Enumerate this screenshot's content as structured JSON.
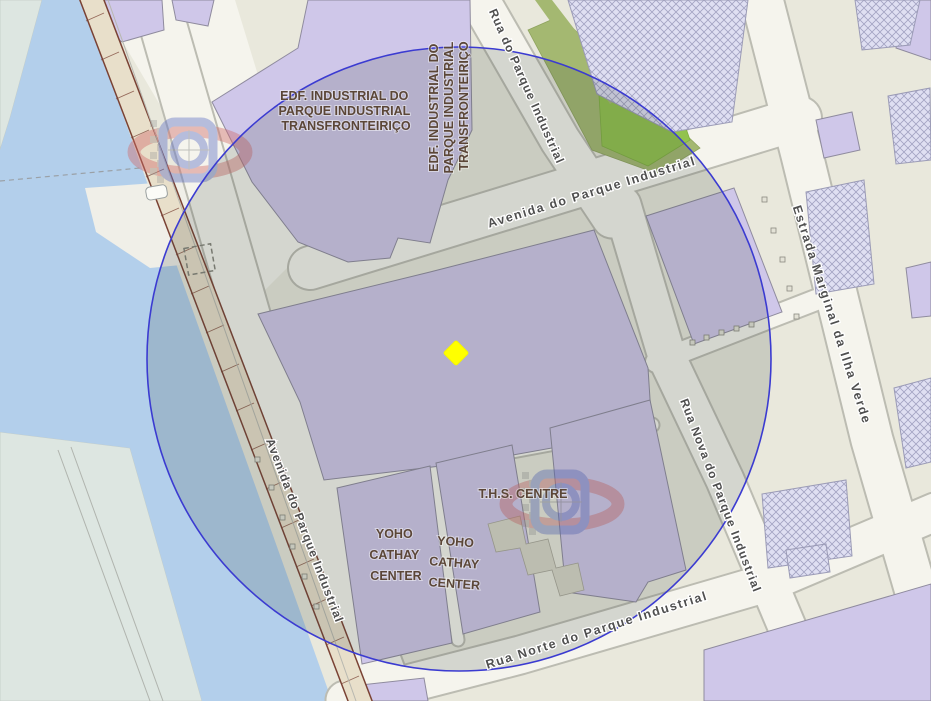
{
  "map": {
    "kind": "cadastral-street-map",
    "street_labels": [
      {
        "id": "avenida-do-parque-industrial-top",
        "text": "Avenida do Parque Industrial"
      },
      {
        "id": "rua-do-parque-industrial",
        "text": "Rua do Parque Industrial"
      },
      {
        "id": "estrada-marginal-da-ilha-verde",
        "text": "Estrada Marginal da Ilha Verde"
      },
      {
        "id": "rua-nova-do-parque-industrial",
        "text": "Rua Nova do Parque Industrial"
      },
      {
        "id": "rua-norte-do-parque-industrial",
        "text": "Rua Norte do Parque Industrial"
      },
      {
        "id": "avenida-do-parque-industrial-left",
        "text": "Avenida do Parque Industrial"
      }
    ],
    "building_labels": [
      {
        "id": "edf-industrial-horizontal",
        "lines": [
          "EDF. INDUSTRIAL DO",
          "PARQUE INDUSTRIAL",
          "TRANSFRONTEIRIÇO"
        ]
      },
      {
        "id": "edf-industrial-vertical",
        "lines": [
          "EDF. INDUSTRIAL DO",
          "PARQUE INDUSTRIAL",
          "TRANSFRONTEIRIÇO"
        ]
      },
      {
        "id": "ths-centre",
        "lines": [
          "T.H.S. CENTRE"
        ]
      },
      {
        "id": "yoho-cathay-center-left",
        "lines": [
          "YOHO",
          "CATHAY",
          "CENTER"
        ]
      },
      {
        "id": "yoho-cathay-center-right",
        "lines": [
          "YOHO",
          "CATHAY",
          "CENTER"
        ]
      }
    ],
    "marker": {
      "id": "selected-location",
      "shape": "diamond",
      "color": "#ffff00",
      "x": 456,
      "y": 353
    },
    "buffer_circle": {
      "center_x": 459,
      "center_y": 359,
      "radius_px": 312,
      "stroke_color": "#3b3bd1",
      "fill_tint": "rgba(55,65,60,0.17)"
    },
    "watermark": {
      "id": "cartography-services-logo",
      "count": 2,
      "red": "#d06a6a",
      "blue": "#6070c5"
    },
    "colors": {
      "water": "#b3cfeb",
      "land": "#e9e8dc",
      "far_shore_land": "#dde6e1",
      "road": "#f5f4ed",
      "building": "#cfc7e9",
      "building_hatched": "#dfdff2",
      "green_dark": "#a4b871",
      "green_bright": "#92c24e",
      "pier_outline": "#7a4234",
      "street_label_text": "#4f4f4f",
      "building_label_text": "#5b4637"
    }
  }
}
